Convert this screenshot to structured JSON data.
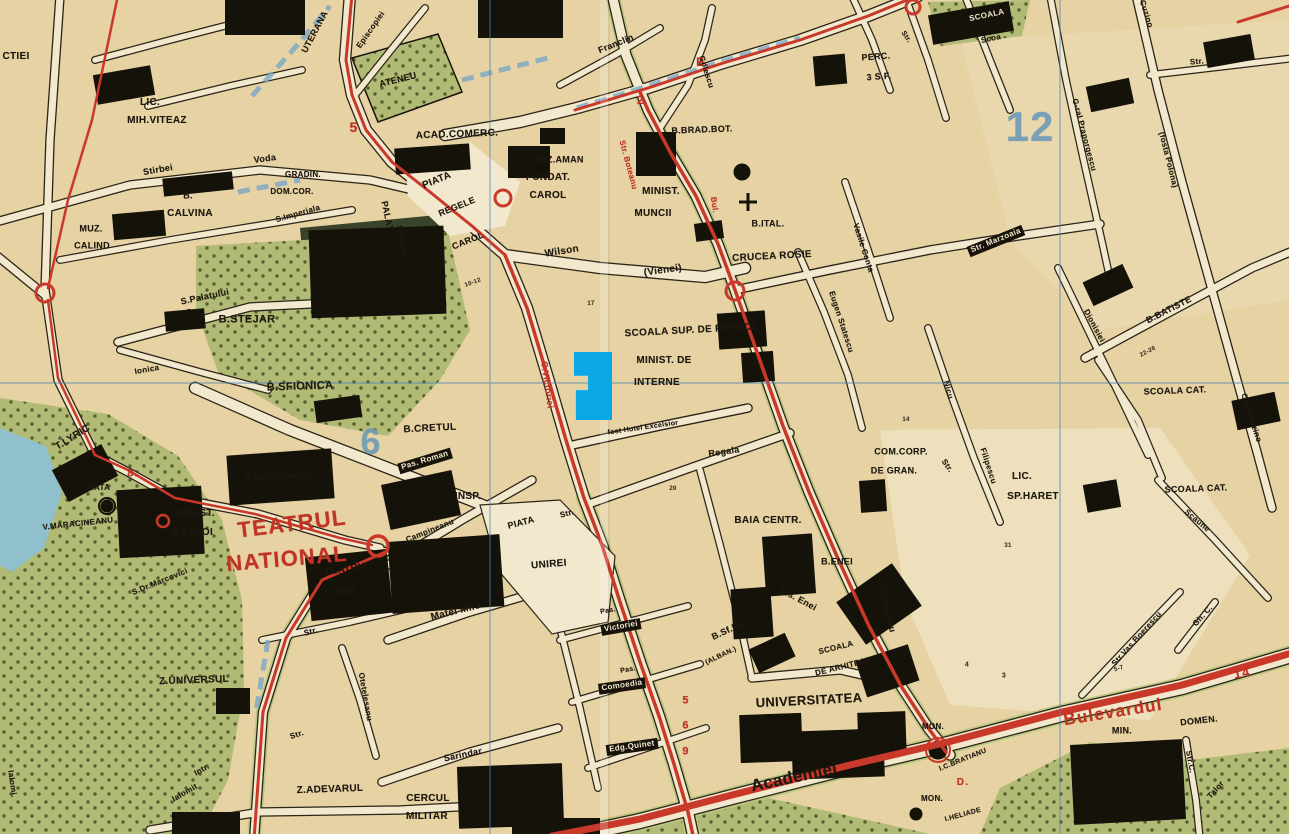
{
  "map": {
    "kind": "vintage-city-street-map",
    "city_hint": "central district plan (Romanian labels)",
    "colors": {
      "paper": "#e6d2a2",
      "street": "#f2e8cd",
      "ink": "#17130b",
      "route_red": "#c9392a",
      "district_blue": "#6d9ab5",
      "park_green": "#b2bb76",
      "water": "#8fc0cc",
      "highlight": "#0aa8e6"
    },
    "district_numbers": [
      "12",
      "6"
    ],
    "route_marks": [
      "5",
      "2",
      "E.",
      "8.",
      "D.",
      "14",
      "5",
      "6",
      "9"
    ],
    "highlight_marker": {
      "x": 574,
      "y": 352,
      "w": 38,
      "h": 68,
      "color": "#0aa8e6",
      "shape": "polygon(0% 0%, 100% 0%, 100% 100%, 5% 100%, 5% 56%, 37% 56%, 37% 35%, 0% 35%)"
    },
    "labels": [
      {
        "t": "CTIEI",
        "x": 16,
        "y": 57,
        "r": 0,
        "s": 10,
        "c": "k"
      },
      {
        "t": "UTERANA",
        "x": 315,
        "y": 32,
        "r": -62,
        "s": 9,
        "c": "k"
      },
      {
        "t": "LIC.",
        "x": 150,
        "y": 103,
        "r": 0,
        "s": 10,
        "c": "k"
      },
      {
        "t": "MIH.VITEAZ",
        "x": 157,
        "y": 121,
        "r": 0,
        "s": 10,
        "c": "k"
      },
      {
        "t": "Stirbei",
        "x": 158,
        "y": 170,
        "r": -10,
        "s": 9,
        "c": "k"
      },
      {
        "t": "Voda",
        "x": 265,
        "y": 159,
        "r": -8,
        "s": 9,
        "c": "k"
      },
      {
        "t": "B.",
        "x": 188,
        "y": 196,
        "r": 0,
        "s": 9,
        "c": "k"
      },
      {
        "t": "CALVINA",
        "x": 190,
        "y": 214,
        "r": 0,
        "s": 10,
        "c": "k"
      },
      {
        "t": "MUZ.",
        "x": 91,
        "y": 229,
        "r": 0,
        "s": 9,
        "c": "k"
      },
      {
        "t": "CALIND",
        "x": 92,
        "y": 246,
        "r": 0,
        "s": 9,
        "c": "k"
      },
      {
        "t": "GRADIN.",
        "x": 303,
        "y": 175,
        "r": 0,
        "s": 8,
        "c": "k"
      },
      {
        "t": "DOM.COR.",
        "x": 292,
        "y": 192,
        "r": 0,
        "s": 8,
        "c": "k"
      },
      {
        "t": "S.Imperiala",
        "x": 298,
        "y": 214,
        "r": -16,
        "s": 8,
        "c": "k"
      },
      {
        "t": "ATENEU",
        "x": 398,
        "y": 80,
        "r": -14,
        "s": 9,
        "c": "k"
      },
      {
        "t": "Episcopiei",
        "x": 371,
        "y": 30,
        "r": -55,
        "s": 8,
        "c": "k"
      },
      {
        "t": "ACAD.COMERC.",
        "x": 457,
        "y": 135,
        "r": -2,
        "s": 10,
        "c": "k"
      },
      {
        "t": "Franclin",
        "x": 616,
        "y": 44,
        "r": -22,
        "s": 9,
        "c": "k"
      },
      {
        "t": "Golescu",
        "x": 706,
        "y": 72,
        "r": 72,
        "s": 8,
        "c": "k"
      },
      {
        "t": "MUZ.AMAN",
        "x": 558,
        "y": 160,
        "r": 0,
        "s": 9,
        "c": "k"
      },
      {
        "t": "FUNDAT.",
        "x": 548,
        "y": 178,
        "r": 0,
        "s": 10,
        "c": "k"
      },
      {
        "t": "CAROL",
        "x": 548,
        "y": 196,
        "r": 0,
        "s": 10,
        "c": "k"
      },
      {
        "t": "MINIST.",
        "x": 661,
        "y": 192,
        "r": 0,
        "s": 10,
        "c": "k"
      },
      {
        "t": "MUNCII",
        "x": 653,
        "y": 214,
        "r": 0,
        "s": 10,
        "c": "k"
      },
      {
        "t": "PIATA",
        "x": 437,
        "y": 181,
        "r": -22,
        "s": 10,
        "c": "k"
      },
      {
        "t": "REGELE",
        "x": 457,
        "y": 207,
        "r": -22,
        "s": 9,
        "c": "k"
      },
      {
        "t": "CAROL",
        "x": 468,
        "y": 241,
        "r": -22,
        "s": 9,
        "c": "k"
      },
      {
        "t": "PALAT",
        "x": 387,
        "y": 216,
        "r": 78,
        "s": 9,
        "c": "k"
      },
      {
        "t": "REGAL",
        "x": 402,
        "y": 242,
        "r": 78,
        "s": 9,
        "c": "k"
      },
      {
        "t": "S.Palatului",
        "x": 205,
        "y": 297,
        "r": -12,
        "s": 9,
        "c": "k"
      },
      {
        "t": "B.STEJAR",
        "x": 247,
        "y": 320,
        "r": 0,
        "s": 11,
        "c": "k"
      },
      {
        "t": "B.SFIONICA",
        "x": 300,
        "y": 387,
        "r": -2,
        "s": 11,
        "c": "k"
      },
      {
        "t": "Ionica",
        "x": 147,
        "y": 370,
        "r": -10,
        "s": 8,
        "c": "k"
      },
      {
        "t": "B.CRETUL",
        "x": 430,
        "y": 429,
        "r": -3,
        "s": 10,
        "c": "k"
      },
      {
        "t": "T.LYRIC",
        "x": 73,
        "y": 438,
        "r": -32,
        "s": 10,
        "c": "k"
      },
      {
        "t": "PIATA",
        "x": 98,
        "y": 488,
        "r": 0,
        "s": 8,
        "c": "k"
      },
      {
        "t": "V.MARACINEANU",
        "x": 78,
        "y": 524,
        "r": -6,
        "s": 8,
        "c": "k"
      },
      {
        "t": "B.BREZOIANU",
        "x": 278,
        "y": 477,
        "r": -4,
        "s": 9,
        "c": "k"
      },
      {
        "t": "MINIST.",
        "x": 196,
        "y": 514,
        "r": 0,
        "s": 10,
        "c": "k"
      },
      {
        "t": "RAZBOI",
        "x": 193,
        "y": 533,
        "r": 0,
        "s": 10,
        "c": "k"
      },
      {
        "t": "TEATRUL",
        "x": 292,
        "y": 524,
        "r": -7,
        "s": 22,
        "c": "R"
      },
      {
        "t": "NATIONAL",
        "x": 287,
        "y": 559,
        "r": -5,
        "s": 22,
        "c": "R"
      },
      {
        "t": "TEATRU",
        "x": 345,
        "y": 570,
        "r": -8,
        "s": 10,
        "c": "k"
      },
      {
        "t": "NAT.",
        "x": 347,
        "y": 593,
        "r": 0,
        "s": 10,
        "c": "k"
      },
      {
        "t": "Matei Milo",
        "x": 456,
        "y": 612,
        "r": -14,
        "s": 10,
        "c": "k"
      },
      {
        "t": "S.Dr.Marcovici",
        "x": 160,
        "y": 582,
        "r": -22,
        "s": 8,
        "c": "k"
      },
      {
        "t": "Pas. Roman",
        "x": 425,
        "y": 461,
        "r": -17,
        "s": 8,
        "c": "i"
      },
      {
        "t": "INSP.",
        "x": 468,
        "y": 497,
        "r": 0,
        "s": 10,
        "c": "k"
      },
      {
        "t": "Campineanu",
        "x": 430,
        "y": 531,
        "r": -22,
        "s": 8,
        "c": "k"
      },
      {
        "t": "PIATA",
        "x": 521,
        "y": 523,
        "r": -15,
        "s": 9,
        "c": "k"
      },
      {
        "t": "Str.",
        "x": 567,
        "y": 514,
        "r": -15,
        "s": 8,
        "c": "k"
      },
      {
        "t": "UNIREI",
        "x": 549,
        "y": 565,
        "r": -5,
        "s": 10,
        "c": "k"
      },
      {
        "t": "Z.UNIVERSUL",
        "x": 194,
        "y": 681,
        "r": -2,
        "s": 10,
        "c": "k"
      },
      {
        "t": "Otetelesanu",
        "x": 365,
        "y": 697,
        "r": 80,
        "s": 8,
        "c": "k"
      },
      {
        "t": "Str.",
        "x": 311,
        "y": 632,
        "r": -15,
        "s": 8,
        "c": "k"
      },
      {
        "t": "Str.",
        "x": 297,
        "y": 735,
        "r": -18,
        "s": 8,
        "c": "k"
      },
      {
        "t": "Sarindar",
        "x": 463,
        "y": 755,
        "r": -12,
        "s": 9,
        "c": "k"
      },
      {
        "t": "Intr.",
        "x": 202,
        "y": 770,
        "r": -30,
        "s": 8,
        "c": "k"
      },
      {
        "t": "Ialomit",
        "x": 185,
        "y": 793,
        "r": -30,
        "s": 8,
        "c": "k"
      },
      {
        "t": "Ialomi.",
        "x": 12,
        "y": 784,
        "r": 82,
        "s": 8,
        "c": "k"
      },
      {
        "t": "Z.ADEVARUL",
        "x": 330,
        "y": 790,
        "r": -2,
        "s": 10,
        "c": "k"
      },
      {
        "t": "CERCUL",
        "x": 428,
        "y": 799,
        "r": 0,
        "s": 10,
        "c": "k"
      },
      {
        "t": "MILITAR",
        "x": 427,
        "y": 817,
        "r": 0,
        "s": 10,
        "c": "k"
      },
      {
        "t": "Pas.",
        "x": 608,
        "y": 611,
        "r": -10,
        "s": 7,
        "c": "k"
      },
      {
        "t": "Victoriei",
        "x": 621,
        "y": 627,
        "r": -10,
        "s": 8,
        "c": "i"
      },
      {
        "t": "Pas.",
        "x": 628,
        "y": 670,
        "r": -10,
        "s": 7,
        "c": "k"
      },
      {
        "t": "Comoedia",
        "x": 622,
        "y": 686,
        "r": -8,
        "s": 8,
        "c": "i"
      },
      {
        "t": "Edg.Quinet",
        "x": 632,
        "y": 747,
        "r": -8,
        "s": 8,
        "c": "i"
      },
      {
        "t": "B.Sf.NIC.",
        "x": 731,
        "y": 629,
        "r": -25,
        "s": 9,
        "c": "k"
      },
      {
        "t": "(ALBAN.)",
        "x": 721,
        "y": 656,
        "r": -25,
        "s": 7,
        "c": "k"
      },
      {
        "t": "Bis. Enei",
        "x": 798,
        "y": 599,
        "r": 28,
        "s": 9,
        "c": "k"
      },
      {
        "t": "B.ENEI",
        "x": 837,
        "y": 562,
        "r": 0,
        "s": 9,
        "c": "k"
      },
      {
        "t": "SCOALA",
        "x": 836,
        "y": 648,
        "r": -14,
        "s": 8,
        "c": "k"
      },
      {
        "t": "DE ARHITECT",
        "x": 843,
        "y": 667,
        "r": -14,
        "s": 8,
        "c": "k"
      },
      {
        "t": "UNIVERSITATEA",
        "x": 809,
        "y": 700,
        "r": -3,
        "s": 13,
        "c": "k"
      },
      {
        "t": "Academiei",
        "x": 794,
        "y": 777,
        "r": -12,
        "s": 17,
        "c": "k"
      },
      {
        "t": "MON.",
        "x": 933,
        "y": 727,
        "r": 0,
        "s": 8,
        "c": "k"
      },
      {
        "t": "I.C.BRATIANU",
        "x": 963,
        "y": 760,
        "r": -22,
        "s": 7,
        "c": "k"
      },
      {
        "t": "MON.",
        "x": 932,
        "y": 799,
        "r": 0,
        "s": 8,
        "c": "k"
      },
      {
        "t": "I.HELIADE",
        "x": 963,
        "y": 815,
        "r": -15,
        "s": 7,
        "c": "k"
      },
      {
        "t": "MIN.",
        "x": 1122,
        "y": 731,
        "r": 0,
        "s": 9,
        "c": "k"
      },
      {
        "t": "DOMEN.",
        "x": 1199,
        "y": 721,
        "r": -6,
        "s": 9,
        "c": "k"
      },
      {
        "t": "Str.C.",
        "x": 1190,
        "y": 762,
        "r": 80,
        "s": 8,
        "c": "k"
      },
      {
        "t": "Talor",
        "x": 1216,
        "y": 790,
        "r": -48,
        "s": 8,
        "c": "k"
      },
      {
        "t": "Str.Vas.Boerescu",
        "x": 1137,
        "y": 639,
        "r": -48,
        "s": 8,
        "c": "k"
      },
      {
        "t": "Gh. C.",
        "x": 1203,
        "y": 616,
        "r": -48,
        "s": 8,
        "c": "k"
      },
      {
        "t": "Bulevardul",
        "x": 1113,
        "y": 712,
        "r": -9,
        "s": 17,
        "c": "R"
      },
      {
        "t": "14",
        "x": 1242,
        "y": 673,
        "r": -10,
        "s": 13,
        "c": "R"
      },
      {
        "t": "C.Victoriei",
        "x": 547,
        "y": 385,
        "r": 82,
        "s": 9,
        "c": "r"
      },
      {
        "t": "Str. Boteanu",
        "x": 628,
        "y": 165,
        "r": 75,
        "s": 8,
        "c": "r"
      },
      {
        "t": "Bul.",
        "x": 714,
        "y": 205,
        "r": 82,
        "s": 8,
        "c": "r"
      },
      {
        "t": "5",
        "x": 354,
        "y": 127,
        "r": 0,
        "s": 14,
        "c": "R"
      },
      {
        "t": "2",
        "x": 641,
        "y": 100,
        "r": 0,
        "s": 12,
        "c": "R"
      },
      {
        "t": "E.",
        "x": 703,
        "y": 62,
        "r": 0,
        "s": 12,
        "c": "R"
      },
      {
        "t": "8.",
        "x": 133,
        "y": 474,
        "r": 0,
        "s": 11,
        "c": "R"
      },
      {
        "t": "D.",
        "x": 963,
        "y": 783,
        "r": 0,
        "s": 10,
        "c": "R"
      },
      {
        "t": "5",
        "x": 686,
        "y": 701,
        "r": 0,
        "s": 11,
        "c": "R"
      },
      {
        "t": "6",
        "x": 686,
        "y": 726,
        "r": 0,
        "s": 11,
        "c": "R"
      },
      {
        "t": "9",
        "x": 686,
        "y": 752,
        "r": 0,
        "s": 11,
        "c": "R"
      },
      {
        "t": "CRUCEA ROSIE",
        "x": 772,
        "y": 257,
        "r": -3,
        "s": 10,
        "c": "k"
      },
      {
        "t": "SCOALA SUP. DE RESBOI",
        "x": 690,
        "y": 331,
        "r": -3,
        "s": 10,
        "c": "k"
      },
      {
        "t": "MINIST. DE",
        "x": 664,
        "y": 361,
        "r": 0,
        "s": 10,
        "c": "k"
      },
      {
        "t": "INTERNE",
        "x": 657,
        "y": 383,
        "r": 0,
        "s": 10,
        "c": "k"
      },
      {
        "t": "fost Hotel Excelsior",
        "x": 643,
        "y": 428,
        "r": -8,
        "s": 7,
        "c": "k"
      },
      {
        "t": "Regala",
        "x": 724,
        "y": 452,
        "r": -8,
        "s": 9,
        "c": "k"
      },
      {
        "t": "BAIA CENTR.",
        "x": 768,
        "y": 521,
        "r": 0,
        "s": 10,
        "c": "k"
      },
      {
        "t": "Eugen Statescu",
        "x": 841,
        "y": 322,
        "r": 72,
        "s": 8,
        "c": "k"
      },
      {
        "t": "Vasile Conta",
        "x": 863,
        "y": 248,
        "r": 72,
        "s": 8,
        "c": "k"
      },
      {
        "t": "Str. Marzoaia",
        "x": 996,
        "y": 241,
        "r": -22,
        "s": 8,
        "c": "i"
      },
      {
        "t": "Nicu",
        "x": 948,
        "y": 390,
        "r": 75,
        "s": 8,
        "c": "k"
      },
      {
        "t": "Filipescu",
        "x": 988,
        "y": 466,
        "r": 72,
        "s": 8,
        "c": "k"
      },
      {
        "t": "Dionisiei",
        "x": 1094,
        "y": 326,
        "r": 62,
        "s": 8,
        "c": "k"
      },
      {
        "t": "B.BATISTE",
        "x": 1169,
        "y": 310,
        "r": -27,
        "s": 9,
        "c": "k"
      },
      {
        "t": "SCOALA CAT.",
        "x": 1175,
        "y": 391,
        "r": -2,
        "s": 9,
        "c": "k"
      },
      {
        "t": "SCOALA CAT.",
        "x": 1196,
        "y": 489,
        "r": -2,
        "s": 9,
        "c": "k"
      },
      {
        "t": "Scaune",
        "x": 1197,
        "y": 521,
        "r": 40,
        "s": 8,
        "c": "k"
      },
      {
        "t": "G-ral Praporgescu",
        "x": 1084,
        "y": 135,
        "r": 75,
        "s": 8,
        "c": "k"
      },
      {
        "t": "(fosta Polona)",
        "x": 1168,
        "y": 160,
        "r": 76,
        "s": 8,
        "c": "k"
      },
      {
        "t": "Cuzino",
        "x": 1146,
        "y": 14,
        "r": 72,
        "s": 8,
        "c": "k"
      },
      {
        "t": "Cantacuzino",
        "x": 1251,
        "y": 418,
        "r": 72,
        "s": 8,
        "c": "k"
      },
      {
        "t": "COM.CORP.",
        "x": 901,
        "y": 452,
        "r": 0,
        "s": 9,
        "c": "k"
      },
      {
        "t": "DE GRAN.",
        "x": 894,
        "y": 471,
        "r": 0,
        "s": 9,
        "c": "k"
      },
      {
        "t": "Str.",
        "x": 947,
        "y": 466,
        "r": 55,
        "s": 8,
        "c": "k"
      },
      {
        "t": "LIC.",
        "x": 1022,
        "y": 477,
        "r": 0,
        "s": 10,
        "c": "k"
      },
      {
        "t": "SP.HARET",
        "x": 1033,
        "y": 497,
        "r": 0,
        "s": 10,
        "c": "k"
      },
      {
        "t": "I.C.Bratianu",
        "x": 886,
        "y": 606,
        "r": 76,
        "s": 9,
        "c": "k"
      },
      {
        "t": "PERC.",
        "x": 876,
        "y": 57,
        "r": -4,
        "s": 9,
        "c": "k"
      },
      {
        "t": "3 S.F.",
        "x": 879,
        "y": 77,
        "r": -4,
        "s": 9,
        "c": "k"
      },
      {
        "t": "SCOALA",
        "x": 987,
        "y": 16,
        "r": -12,
        "s": 8,
        "c": "i"
      },
      {
        "t": "Scoa",
        "x": 991,
        "y": 39,
        "r": -12,
        "s": 8,
        "c": "k"
      },
      {
        "t": "B.BRAD.BOT.",
        "x": 702,
        "y": 130,
        "r": -2,
        "s": 9,
        "c": "k"
      },
      {
        "t": "B.ITAL.",
        "x": 768,
        "y": 224,
        "r": 0,
        "s": 9,
        "c": "k"
      },
      {
        "t": "12",
        "x": 1030,
        "y": 127,
        "r": 0,
        "s": 42,
        "c": "b"
      },
      {
        "t": "6",
        "x": 371,
        "y": 442,
        "r": 0,
        "s": 36,
        "c": "b"
      },
      {
        "t": "Wilson",
        "x": 562,
        "y": 252,
        "r": -9,
        "s": 10,
        "c": "k"
      },
      {
        "t": "(Vienei)",
        "x": 663,
        "y": 271,
        "r": -8,
        "s": 10,
        "c": "k"
      },
      {
        "t": "Str.",
        "x": 1197,
        "y": 62,
        "r": -5,
        "s": 8,
        "c": "k"
      },
      {
        "t": "Str.",
        "x": 906,
        "y": 37,
        "r": 55,
        "s": 7,
        "c": "k"
      },
      {
        "t": "Str.",
        "x": 797,
        "y": 571,
        "r": 60,
        "s": 7,
        "c": "k"
      },
      {
        "t": "17",
        "x": 591,
        "y": 304,
        "r": 0,
        "s": 6,
        "c": "n"
      },
      {
        "t": "7",
        "x": 758,
        "y": 333,
        "r": 0,
        "s": 6,
        "c": "n"
      },
      {
        "t": "20",
        "x": 673,
        "y": 489,
        "r": 0,
        "s": 6,
        "c": "n"
      },
      {
        "t": "4",
        "x": 967,
        "y": 665,
        "r": 0,
        "s": 7,
        "c": "n"
      },
      {
        "t": "3",
        "x": 1004,
        "y": 676,
        "r": 0,
        "s": 7,
        "c": "n"
      },
      {
        "t": "5-7",
        "x": 1119,
        "y": 669,
        "r": -18,
        "s": 6,
        "c": "n"
      },
      {
        "t": "31",
        "x": 1008,
        "y": 546,
        "r": 0,
        "s": 6,
        "c": "n"
      },
      {
        "t": "14",
        "x": 906,
        "y": 420,
        "r": 0,
        "s": 6,
        "c": "n"
      },
      {
        "t": "10-12",
        "x": 473,
        "y": 283,
        "r": -20,
        "s": 6,
        "c": "n"
      },
      {
        "t": "22-26",
        "x": 1148,
        "y": 352,
        "r": -28,
        "s": 6,
        "c": "n"
      }
    ]
  }
}
